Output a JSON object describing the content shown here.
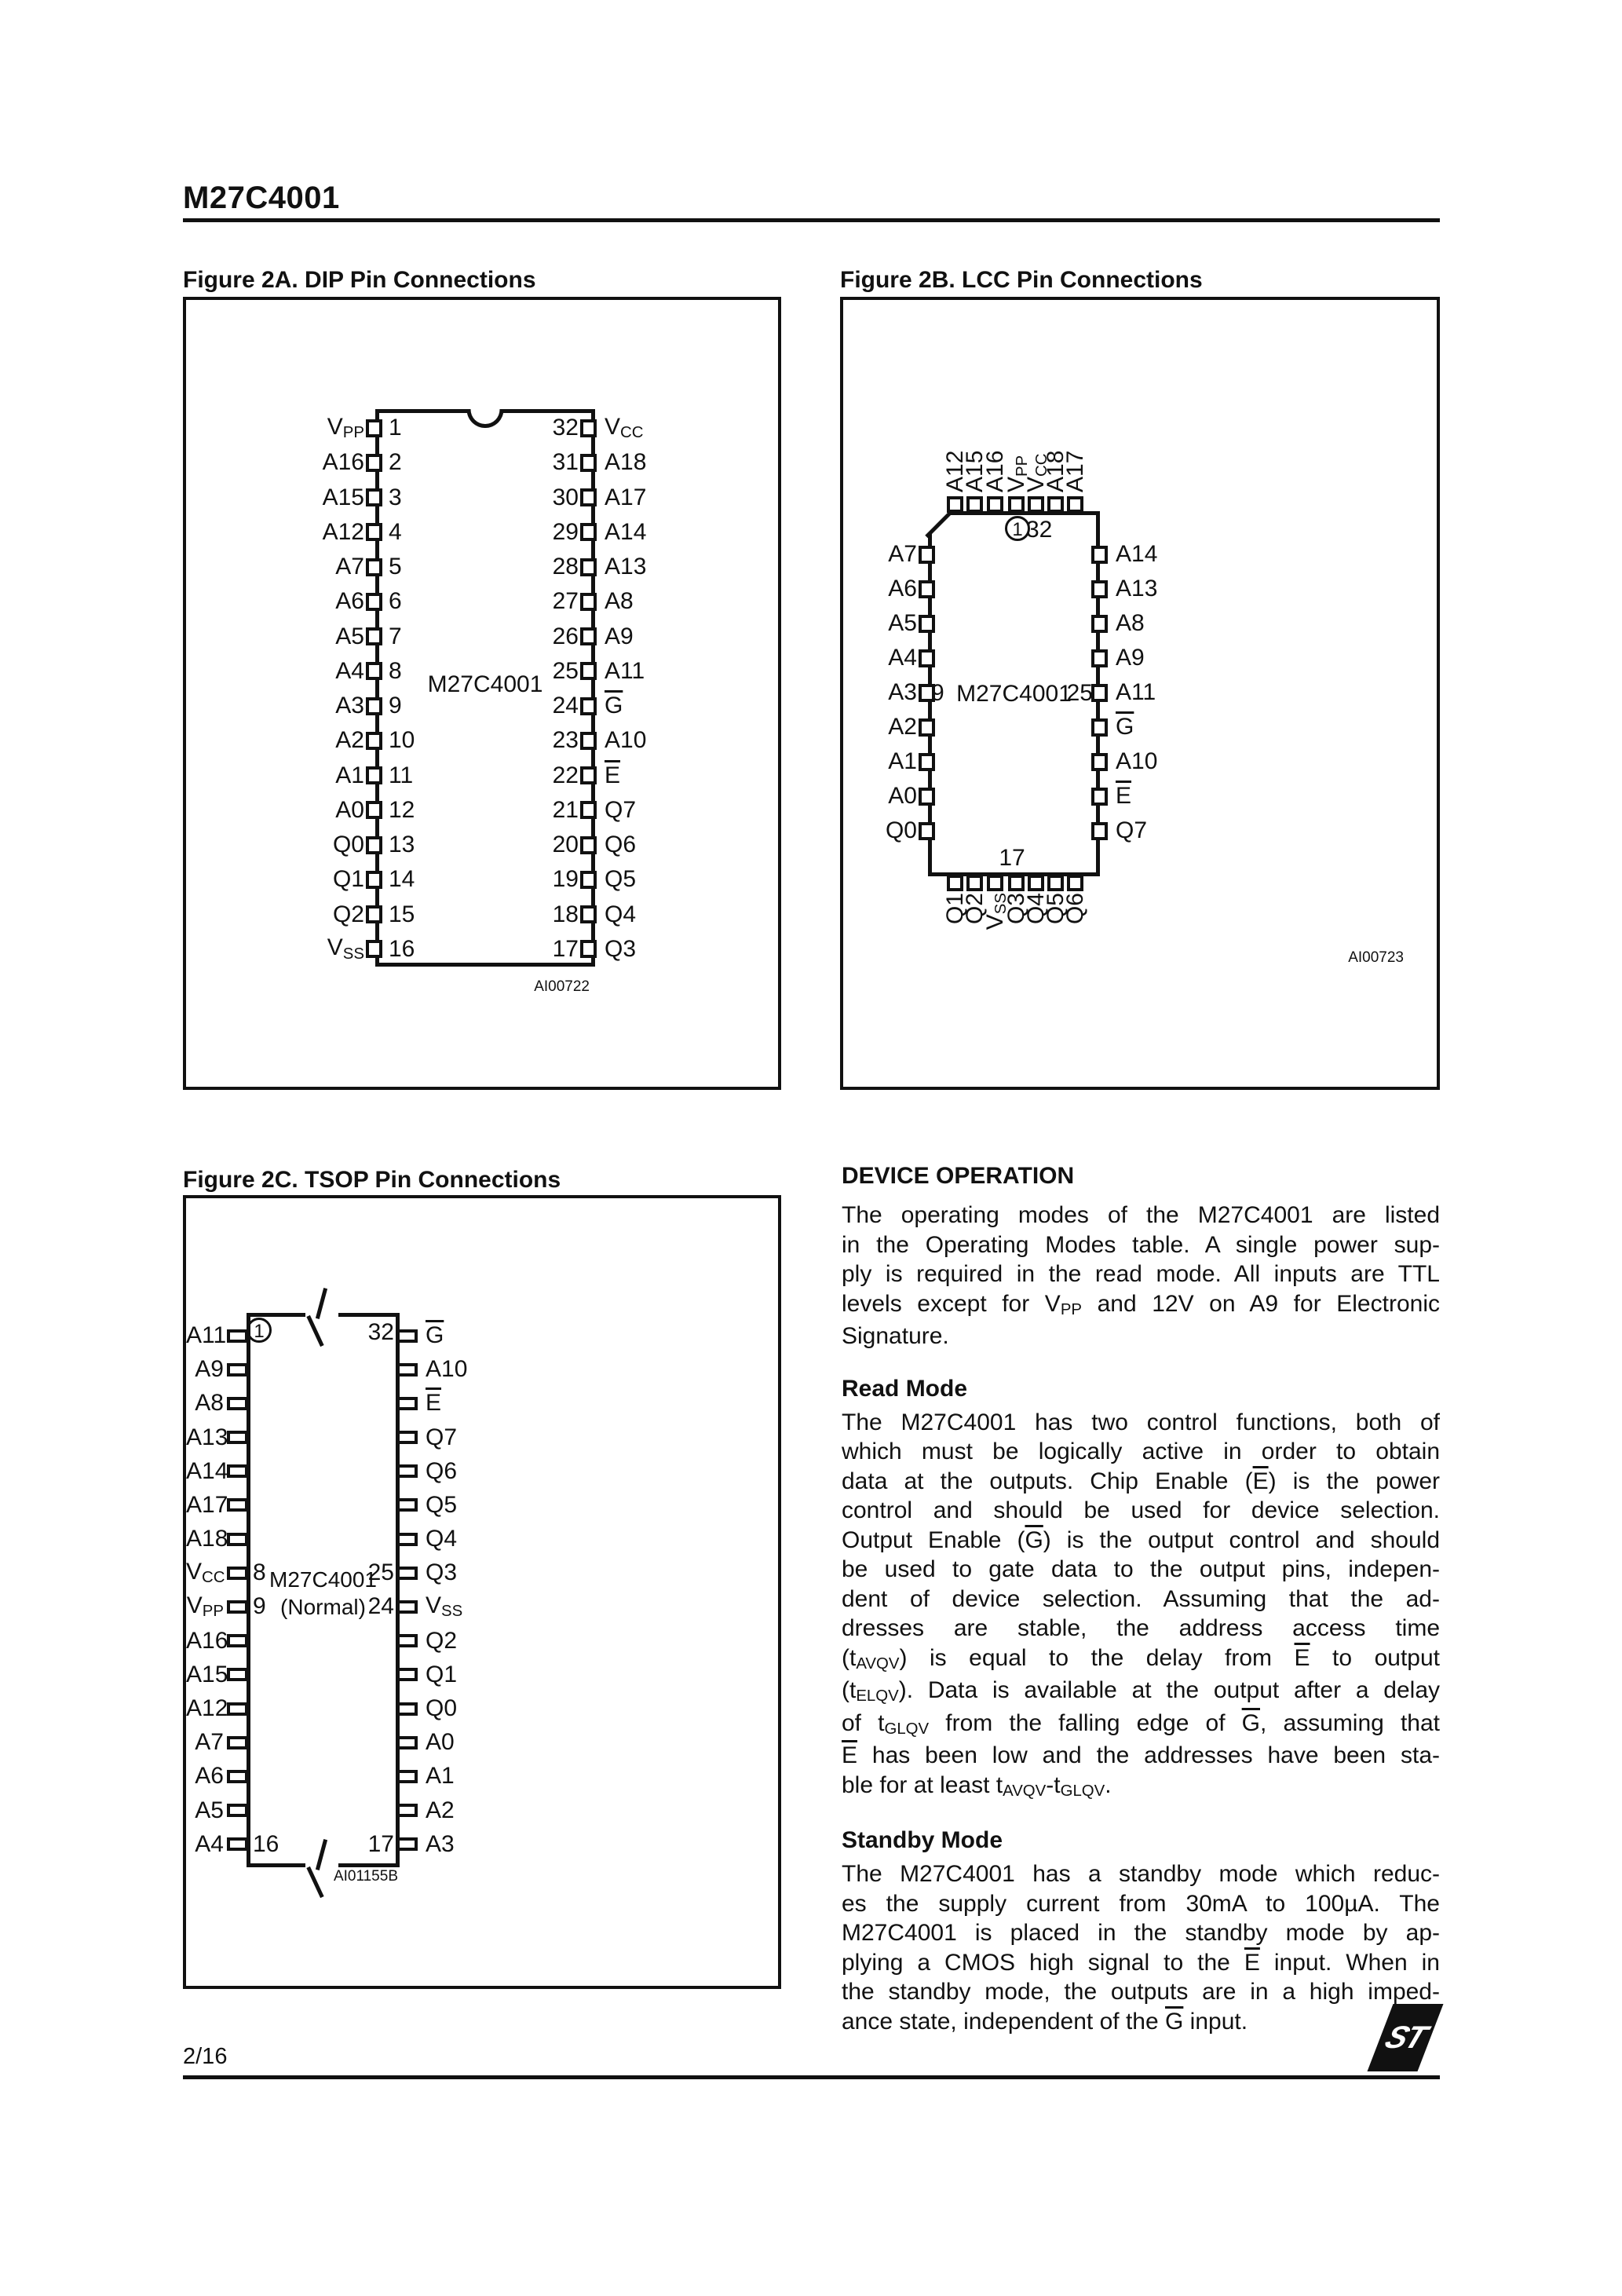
{
  "page": {
    "title": "M27C4001",
    "footer_page": "2/16",
    "logo_text": "ST"
  },
  "figures": {
    "dip": {
      "title": "Figure 2A. DIP Pin Connections",
      "chip_label": "M27C4001",
      "caption": "AI00722",
      "rows": [
        {
          "left": "V[sub]PP[/sub]",
          "ln": "1",
          "rn": "32",
          "right": "V[sub]CC[/sub]"
        },
        {
          "left": "A16",
          "ln": "2",
          "rn": "31",
          "right": "A18"
        },
        {
          "left": "A15",
          "ln": "3",
          "rn": "30",
          "right": "A17"
        },
        {
          "left": "A12",
          "ln": "4",
          "rn": "29",
          "right": "A14"
        },
        {
          "left": "A7",
          "ln": "5",
          "rn": "28",
          "right": "A13"
        },
        {
          "left": "A6",
          "ln": "6",
          "rn": "27",
          "right": "A8"
        },
        {
          "left": "A5",
          "ln": "7",
          "rn": "26",
          "right": "A9"
        },
        {
          "left": "A4",
          "ln": "8",
          "rn": "25",
          "right": "A11"
        },
        {
          "left": "A3",
          "ln": "9",
          "rn": "24",
          "right": "[ovl]G[/ovl]"
        },
        {
          "left": "A2",
          "ln": "10",
          "rn": "23",
          "right": "A10"
        },
        {
          "left": "A1",
          "ln": "11",
          "rn": "22",
          "right": "[ovl]E[/ovl]"
        },
        {
          "left": "A0",
          "ln": "12",
          "rn": "21",
          "right": "Q7"
        },
        {
          "left": "Q0",
          "ln": "13",
          "rn": "20",
          "right": "Q6"
        },
        {
          "left": "Q1",
          "ln": "14",
          "rn": "19",
          "right": "Q5"
        },
        {
          "left": "Q2",
          "ln": "15",
          "rn": "18",
          "right": "Q4"
        },
        {
          "left": "V[sub]SS[/sub]",
          "ln": "16",
          "rn": "17",
          "right": "Q3"
        }
      ]
    },
    "lcc": {
      "title": "Figure 2B. LCC Pin Connections",
      "chip_label": "M27C4001",
      "caption": "AI00723",
      "pin1_label": "1",
      "pin32_label": "32",
      "left_num": "9",
      "right_num": "25",
      "bottom_num": "17",
      "top": [
        "A12",
        "A15",
        "A16",
        "V[sub]PP[/sub]",
        "V[sub]CC[/sub]",
        "A18",
        "A17"
      ],
      "left": [
        "A7",
        "A6",
        "A5",
        "A4",
        "A3",
        "A2",
        "A1",
        "A0",
        "Q0"
      ],
      "right": [
        "A14",
        "A13",
        "A8",
        "A9",
        "A11",
        "[ovl]G[/ovl]",
        "A10",
        "[ovl]E[/ovl]",
        "Q7"
      ],
      "bottom": [
        "Q1",
        "Q2",
        "V[sub]SS[/sub]",
        "Q3",
        "Q4",
        "Q5",
        "Q6"
      ]
    },
    "tsop": {
      "title": "Figure 2C. TSOP Pin Connections",
      "chip_label": "M27C4001",
      "chip_sublabel": "(Normal)",
      "caption": "AI01155B",
      "nums": {
        "p1": "1",
        "p32": "32",
        "p8": "8",
        "p9": "9",
        "p25": "25",
        "p24": "24",
        "p16": "16",
        "p17": "17"
      },
      "rows": [
        {
          "left": "A11",
          "right": "[ovl]G[/ovl]"
        },
        {
          "left": "A9",
          "right": "A10"
        },
        {
          "left": "A8",
          "right": "[ovl]E[/ovl]"
        },
        {
          "left": "A13",
          "right": "Q7"
        },
        {
          "left": "A14",
          "right": "Q6"
        },
        {
          "left": "A17",
          "right": "Q5"
        },
        {
          "left": "A18",
          "right": "Q4"
        },
        {
          "left": "V[sub]CC[/sub]",
          "right": "Q3"
        },
        {
          "left": "V[sub]PP[/sub]",
          "right": "V[sub]SS[/sub]"
        },
        {
          "left": "A16",
          "right": "Q2"
        },
        {
          "left": "A15",
          "right": "Q1"
        },
        {
          "left": "A12",
          "right": "Q0"
        },
        {
          "left": "A7",
          "right": "A0"
        },
        {
          "left": "A6",
          "right": "A1"
        },
        {
          "left": "A5",
          "right": "A2"
        },
        {
          "left": "A4",
          "right": "A3"
        }
      ]
    }
  },
  "device_operation": {
    "heading": "DEVICE OPERATION",
    "intro_lines": [
      "The operating modes of the M27C4001 are listed",
      "in the Operating Modes table. A single power sup-",
      "ply is required in the read mode. All inputs are TTL",
      "levels except for V[sub]PP[/sub] and 12V on A9 for Electronic",
      "Signature."
    ],
    "read_mode_heading": "Read Mode",
    "read_mode_lines": [
      "The M27C4001 has two control functions, both of",
      "which must be logically active in order to obtain",
      "data at the outputs. Chip Enable ([ovl]E[/ovl]) is the power",
      "control and should be used for device selection.",
      "Output Enable ([ovl]G[/ovl]) is the output control and should",
      "be used to gate data to the output pins, indepen-",
      "dent of device selection. Assuming that the ad-",
      "dresses are stable, the address access time",
      "(t[sub]AVQV[/sub]) is equal to the delay from [ovl]E[/ovl] to output",
      "(t[sub]ELQV[/sub]). Data is available at the output after a delay",
      "of t[sub]GLQV[/sub] from the falling edge of [ovl]G[/ovl], assuming that",
      "[ovl]E[/ovl] has been low and the addresses have been sta-",
      "ble for at least t[sub]AVQV[/sub]-t[sub]GLQV[/sub]."
    ],
    "standby_heading": "Standby Mode",
    "standby_lines": [
      "The M27C4001 has a standby mode which reduc-",
      "es the supply current from 30mA to 100µA. The",
      "M27C4001 is placed in the standby mode by ap-",
      "plying a CMOS high signal to the [ovl]E[/ovl] input. When in",
      "the standby mode, the outputs are in a high imped-",
      "ance state, independent of the [ovl]G[/ovl] input."
    ]
  }
}
